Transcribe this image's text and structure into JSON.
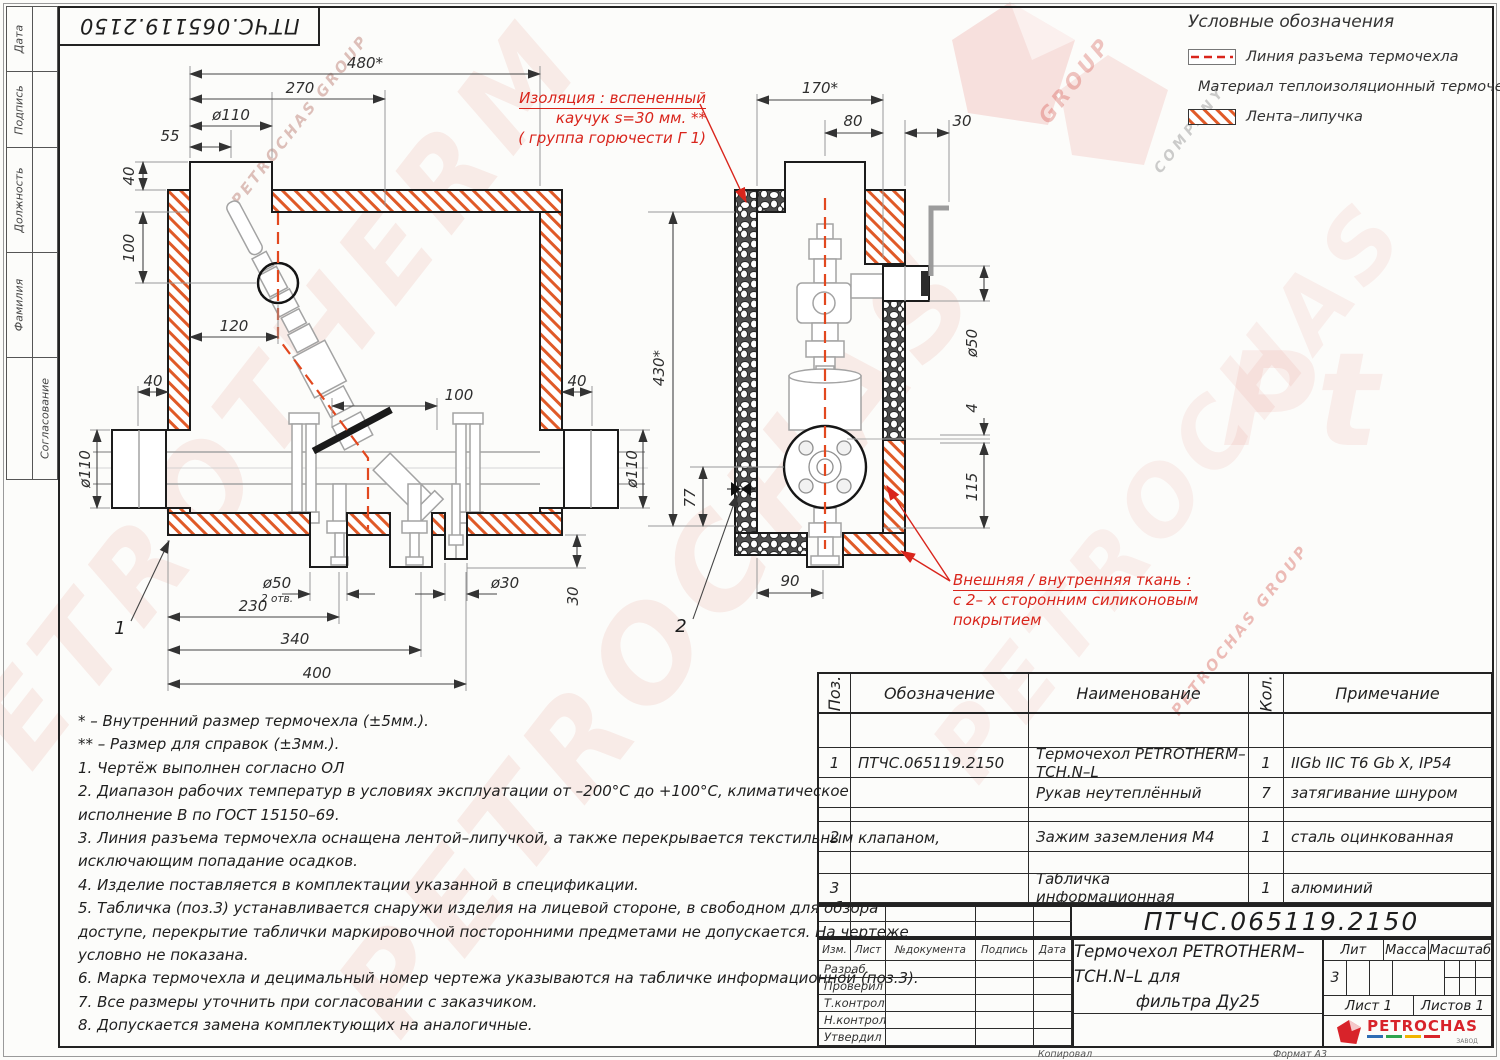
{
  "margin": {
    "labels": [
      "Дата",
      "Подпись",
      "Должность",
      "Фамилия",
      "Согласование"
    ],
    "doc_number": "ПТЧС.065119.2150"
  },
  "legend": {
    "title": "Условные обозначения",
    "items": [
      {
        "label": "Линия разъема термочехла"
      },
      {
        "label": "Материал теплоизоляционный термочехла"
      },
      {
        "label": "Лента–липучка"
      }
    ]
  },
  "callouts": {
    "insulation": {
      "line1": "Изоляция : вспененный",
      "line2": "каучук  s=30 мм. **",
      "line3": "( группа горючести Г 1)"
    },
    "fabric": {
      "line1": "Внешняя / внутренняя ткань :",
      "line2": "с  2– х сторонним силиконовым",
      "line3": "покрытием"
    }
  },
  "dims": {
    "front": {
      "w480": "480*",
      "w270": "270",
      "d110": "ø110",
      "w55": "55",
      "h40": "40",
      "h100": "100",
      "w120": "120",
      "wall40l": "40",
      "wall40r": "40",
      "mid100": "100",
      "pipe110l": "ø110",
      "pipe110r": "ø110",
      "d50": "ø50",
      "holes": "2 отв.",
      "d30": "ø30",
      "b230": "230",
      "b340": "340",
      "b400": "400",
      "v30": "30",
      "pos1": "1"
    },
    "side": {
      "w170": "170*",
      "w80": "80",
      "w30": "30",
      "d50": "ø50",
      "g4": "4",
      "h115": "115",
      "h430": "430*",
      "h77": "77",
      "b90": "90",
      "pos2": "2"
    }
  },
  "notes": [
    "*  – Внутренний размер термочехла (±5мм.).",
    "** – Размер для справок (±3мм.).",
    "1. Чертёж выполнен согласно ОЛ",
    "2. Диапазон рабочих температур в условиях эксплуатации от –200°С до +100°С, климатическое",
    "исполнение В по ГОСТ 15150–69.",
    "3. Линия разъема термочехла оснащена лентой–липучкой, а также перекрывается текстильным клапаном,",
    "исключающим попадание осадков.",
    "4. Изделие поставляется в комплектации указанной в спецификации.",
    "5. Табличка (поз.3) устанавливается снаружи изделия на лицевой стороне, в свободном для обзора",
    "доступе, перекрытие таблички маркировочной посторонними предметами не допускается. На чертеже",
    "условно не показана.",
    "6. Марка термочехла и децимальный номер чертежа указываются на табличке информационной (поз.3).",
    "7. Все размеры уточнить при согласовании с заказчиком.",
    "8. Допускается замена комплектующих на аналогичные."
  ],
  "parts": {
    "headers": [
      "Поз.",
      "Обозначение",
      "Наименование",
      "Кол.",
      "Примечание"
    ],
    "rows": [
      {
        "pos": "",
        "designation": "",
        "name": "",
        "qty": "",
        "note": ""
      },
      {
        "pos": "1",
        "designation": "ПТЧС.065119.2150",
        "name": "Термочехол PETROTHERM–TCH.N–L",
        "qty": "1",
        "note": "IIGb IIC T6 Gb X, IP54"
      },
      {
        "pos": "",
        "designation": "",
        "name": "Рукав неутеплённый",
        "qty": "7",
        "note": "затягивание шнуром"
      },
      {
        "pos": "",
        "designation": "",
        "name": "",
        "qty": "",
        "note": ""
      },
      {
        "pos": "2",
        "designation": "",
        "name": "Зажим заземления М4",
        "qty": "1",
        "note": "сталь оцинкованная"
      },
      {
        "pos": "",
        "designation": "",
        "name": "",
        "qty": "",
        "note": ""
      },
      {
        "pos": "3",
        "designation": "",
        "name": "Табличка информационная",
        "qty": "1",
        "note": "алюминий"
      }
    ]
  },
  "stamp": {
    "doc_number": "ПТЧС.065119.2150",
    "cols": [
      "Изм.",
      "Лист",
      "№документа",
      "Подпись",
      "Дата"
    ],
    "roles": [
      "Разраб.",
      "Проверил",
      "Т.контроль",
      "Н.контроль",
      "Утвердил"
    ],
    "title_line1": "Термочехол PETROTHERM–TCH.N–L для",
    "title_line2": "фильтра Ду25",
    "lit": "Лит",
    "mass": "Масса",
    "scale": "Масштаб",
    "lit_value": "3",
    "sheet": "Лист 1",
    "sheets": "Листов  1",
    "logo": "PETROCHAS",
    "logo_sub": "ЗАВОД"
  },
  "footer": {
    "copied": "Копировал",
    "format": "Формат А3"
  },
  "watermarks": {
    "w1": "PETROTHERM",
    "w2": "PETROCHAS",
    "w3": "PETROCHAS",
    "small1": "PETROCHAS GROUP",
    "small2": "PETROCHAS GROUP",
    "small3": "COMPANY",
    "small4": "GROUP",
    "pt": "Pt"
  }
}
